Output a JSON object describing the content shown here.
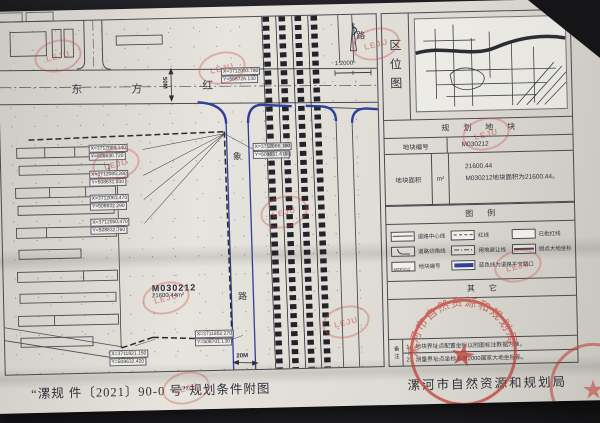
{
  "document": {
    "sheet_title": "“漯规 件〔2021〕90-0 号”规划条件附图",
    "agency": "漯河市自然资源和规划局",
    "seal_text": "漯河市自然资源和规划局",
    "watermark": "LEJU"
  },
  "map": {
    "scale": "1:2000",
    "road_h": [
      "东",
      "方",
      "红"
    ],
    "road_v": [
      "象",
      "路"
    ],
    "road_r": "路",
    "width_h": "50M",
    "width_v": "20M",
    "plot_id": "M030212",
    "plot_area": "21600.44m²",
    "coords": [
      {
        "x": "X=3712093.780",
        "y": "Y=508726.130"
      },
      {
        "x": "X=3712089.140",
        "y": "Y=508630.720"
      },
      {
        "x": "X=3712086.160",
        "y": "Y=508631.410"
      },
      {
        "x": "X=3712085.280",
        "y": "Y=508631.030"
      },
      {
        "x": "X=3712061.470",
        "y": "Y=508632.290"
      },
      {
        "x": "X=3712050.470",
        "y": "Y=508632.760"
      },
      {
        "x": "X=3711852.270",
        "y": "Y=508701.130"
      },
      {
        "x": "X=3711821.150",
        "y": "Y=508632.420"
      }
    ]
  },
  "panel": {
    "location_title": "区位图",
    "section_title": "规划地块",
    "plot_no_label": "地块编号",
    "plot_no_value": "M030212",
    "area_label": "地块面积",
    "area_unit": "m²",
    "area_value": "21600.44",
    "area_note": "M030212地块面积为21600.44。",
    "legend_title": "图例",
    "legend_items": [
      {
        "label": "道路中心线",
        "type": "centerline"
      },
      {
        "label": "红线",
        "type": "redline"
      },
      {
        "label": "已批红线",
        "type": "approved"
      },
      {
        "label": "道路切角线",
        "type": "corner"
      },
      {
        "label": "用地退让线",
        "type": "setback"
      },
      {
        "label": "拐点大地坐标",
        "type": "coord"
      },
      {
        "label": "地块编号",
        "type": "plot-no",
        "symbol_text": "M030212"
      },
      {
        "label": "蓝色线为道路平交路口",
        "type": "blue-road"
      }
    ],
    "other_title": "其它",
    "notes_label": "备注",
    "notes": [
      "1、地块界址点配置坐标以附图标注数据为准。",
      "2、测量界址点坐标采用2000国家大地坐标系。"
    ]
  }
}
